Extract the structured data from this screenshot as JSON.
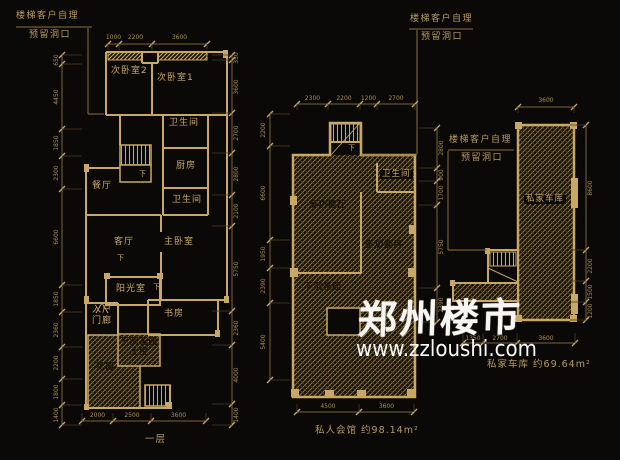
{
  "watermark": {
    "brand": "郑州楼市",
    "url": "www.zzloushi.com"
  },
  "callouts": {
    "floor1": {
      "line1": "楼梯客户自理",
      "line2": "预留洞口"
    },
    "club": {
      "line1": "楼梯客户自理",
      "line2": "预留洞口"
    },
    "garage": {
      "line1": "楼梯客户自理",
      "line2": "预留洞口"
    }
  },
  "areas": {
    "floor1_footer": "一层",
    "club": "私人会馆 约98.14m²",
    "garage": "私家车库 约69.64m²"
  },
  "rooms": [
    {
      "n": "room-label-bedroom2",
      "t": "次卧室2",
      "x": 111,
      "y": 67,
      "c": "room"
    },
    {
      "n": "room-label-bedroom1",
      "t": "次卧室1",
      "x": 157,
      "y": 74,
      "c": "room"
    },
    {
      "n": "room-label-bath-upper",
      "t": "卫生间",
      "x": 169,
      "y": 119,
      "c": "room"
    },
    {
      "n": "room-label-kitchen",
      "t": "厨房",
      "x": 176,
      "y": 162,
      "c": "room"
    },
    {
      "n": "room-label-bath-lower",
      "t": "卫生间",
      "x": 172,
      "y": 196,
      "c": "room"
    },
    {
      "n": "room-label-dining",
      "t": "餐厅",
      "x": 92,
      "y": 182,
      "c": "room"
    },
    {
      "n": "room-label-living",
      "t": "客厅",
      "x": 114,
      "y": 238,
      "c": "room"
    },
    {
      "n": "room-label-master",
      "t": "主卧室",
      "x": 164,
      "y": 238,
      "c": "room"
    },
    {
      "n": "room-label-sunroom",
      "t": "阳光室",
      "x": 116,
      "y": 285,
      "c": "room"
    },
    {
      "n": "room-label-entry-1",
      "t": "入户",
      "x": 92,
      "y": 306,
      "c": "room"
    },
    {
      "n": "room-label-entry-2",
      "t": "门廊",
      "x": 92,
      "y": 317,
      "c": "room"
    },
    {
      "n": "room-label-study",
      "t": "书房",
      "x": 164,
      "y": 310,
      "c": "room"
    },
    {
      "n": "room-label-garden",
      "t": "花园",
      "x": 96,
      "y": 363,
      "c": "roomd"
    },
    {
      "n": "room-label-sunken-1",
      "t": "下沉花园",
      "x": 120,
      "y": 338,
      "c": "roomd"
    },
    {
      "n": "room-label-sunken-2",
      "t": "上空",
      "x": 130,
      "y": 348,
      "c": "roomd"
    },
    {
      "n": "down-arrow-label",
      "t": "下",
      "x": 139,
      "y": 171,
      "c": "down"
    },
    {
      "n": "down-arrow-label",
      "t": "下",
      "x": 117,
      "y": 255,
      "c": "down"
    },
    {
      "n": "down-arrow-label",
      "t": "下",
      "x": 153,
      "y": 284,
      "c": "down"
    },
    {
      "n": "room-label-club-bath",
      "t": "卫生间",
      "x": 380,
      "y": 170,
      "c": "rooms"
    },
    {
      "n": "room-label-club-hall",
      "t": "多功能厅",
      "x": 309,
      "y": 201,
      "c": "roomd"
    },
    {
      "n": "room-label-club-room",
      "t": "多功能房",
      "x": 365,
      "y": 241,
      "c": "roomd"
    },
    {
      "n": "room-label-club-sunken",
      "t": "下沉花园",
      "x": 304,
      "y": 283,
      "c": "roomd"
    },
    {
      "n": "down-arrow-label",
      "t": "下",
      "x": 348,
      "y": 145,
      "c": "down"
    },
    {
      "n": "room-label-garage",
      "t": "私家车库",
      "x": 524,
      "y": 195,
      "c": "rooms"
    }
  ],
  "dims": [
    {
      "n": "floor1-top",
      "d": "h",
      "pos": 44,
      "s": 6,
      "ticks": [
        108,
        119,
        152,
        207
      ],
      "lab": -9,
      "v": [
        "1000",
        "2200",
        "3600"
      ]
    },
    {
      "n": "floor1-left",
      "d": "v",
      "pos": 62,
      "s": 20,
      "ticks": [
        55,
        64,
        129,
        156,
        189,
        285,
        312,
        347,
        379,
        405,
        425
      ],
      "lab": -5,
      "v": [
        "650",
        "4450",
        "1850",
        "2300",
        "6600",
        "1850",
        "2360",
        "2200",
        "1800",
        "1400"
      ]
    },
    {
      "n": "floor1-right",
      "d": "v",
      "pos": 232,
      "s": -20,
      "ticks": [
        55,
        60,
        113,
        153,
        195,
        226,
        311,
        345,
        404,
        425
      ],
      "lab": 5,
      "v": [
        "350",
        "3600",
        "2700",
        "2800",
        "2100",
        "5750",
        "2360",
        "4000",
        "1400"
      ]
    },
    {
      "n": "floor1-bottom",
      "d": "h",
      "pos": 421,
      "s": -8,
      "ticks": [
        82,
        113,
        151,
        206
      ],
      "lab": -8,
      "v": [
        "2000",
        "2500",
        "3600"
      ]
    },
    {
      "n": "club-top",
      "d": "h",
      "pos": 104,
      "s": 6,
      "ticks": [
        297,
        328,
        360,
        377,
        415
      ],
      "lab": -8,
      "v": [
        "2300",
        "2200",
        "1200",
        "2700"
      ]
    },
    {
      "n": "club-left",
      "d": "v",
      "pos": 270,
      "s": 20,
      "ticks": [
        114,
        146,
        240,
        268,
        303,
        380
      ],
      "lab": -6,
      "v": [
        "2200",
        "6600",
        "1950",
        "2390",
        "5400"
      ]
    },
    {
      "n": "club-right",
      "d": "v",
      "pos": 437,
      "s": -18,
      "ticks": [
        128,
        168,
        181,
        205,
        288,
        322
      ],
      "lab": 5,
      "v": [
        "2800",
        "900",
        "1700",
        "5750",
        "2390"
      ]
    },
    {
      "n": "club-bottom",
      "d": "h",
      "pos": 412,
      "s": -8,
      "ticks": [
        297,
        359,
        414
      ],
      "lab": -8,
      "v": [
        "4500",
        "3600"
      ]
    },
    {
      "n": "garage-top",
      "d": "h",
      "pos": 107,
      "s": 6,
      "ticks": [
        518,
        574
      ],
      "lab": -9,
      "v": [
        "3600"
      ]
    },
    {
      "n": "garage-right",
      "d": "v",
      "pos": 586,
      "s": -16,
      "ticks": [
        125,
        250,
        281,
        302,
        320
      ],
      "lab": 5,
      "v": [
        "8600",
        "2200",
        "1500",
        "1200"
      ]
    },
    {
      "n": "garage-bottom",
      "d": "h",
      "pos": 343,
      "s": -10,
      "ticks": [
        463,
        483,
        517,
        575
      ],
      "lab": -7,
      "v": [
        "1350",
        "2700",
        "3600"
      ]
    }
  ],
  "colors": {
    "background": "#0b0907",
    "line_gold": "#c9a765",
    "hatch_gold": "#9c8045",
    "dim_text": "#a88d52",
    "watermark_white": "#f7f6f3"
  }
}
